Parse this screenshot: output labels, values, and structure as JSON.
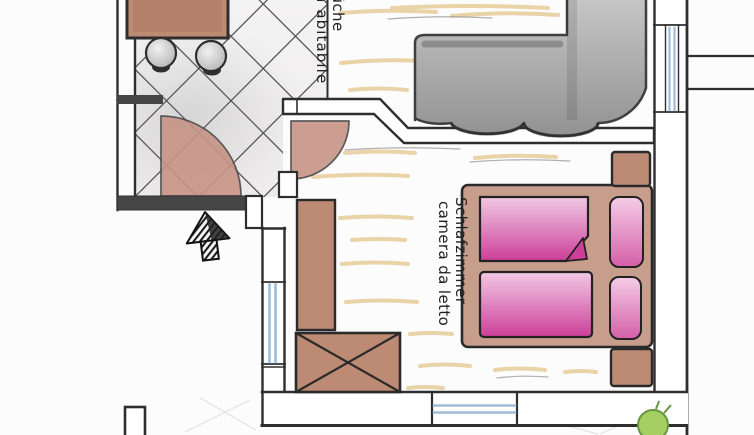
{
  "rooms": {
    "kitchen": {
      "line1": "Küche",
      "line2": "cucina abitabile"
    },
    "bedroom": {
      "line1": "Schlafzimmer",
      "line2": "camera da letto"
    }
  },
  "colors": {
    "paper": "#fcfcfd",
    "ink": "#2e2e2e",
    "wall_fill": "#454545",
    "furn_brown": "#bd8a74",
    "bedframe_brown": "#c79d8b",
    "door_brown": "#c79486",
    "pink_deep": "#cf3e9b",
    "pink_light": "#eebbdc",
    "sofa_gray": "#9c9c9c",
    "floor_tan": "#e7cf9e",
    "window_blue": "#9fbcd8",
    "plant_green": "#a5cf62"
  }
}
